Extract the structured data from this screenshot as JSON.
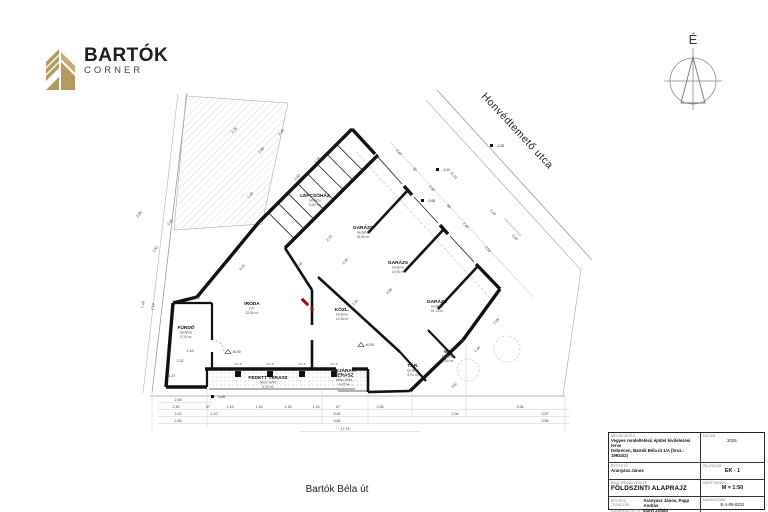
{
  "logo": {
    "name": "BARTÓK",
    "sub": "CORNER",
    "gold": "#b49a5f",
    "dark": "#1d1d1b"
  },
  "north": {
    "label": "É"
  },
  "streets": {
    "top": "Honvédtemető utca",
    "bottom": "Bartók Béla út"
  },
  "boundary_label": "TELEKHATÁR",
  "title_block": {
    "labels": {
      "project": "megnevezés",
      "client": "építtető",
      "date": "dátum",
      "drawing_no": "rajzszám",
      "title": "rajz megnevezése",
      "scale": "méretarány",
      "designers": "építész tervezők",
      "editor": "szerkesztette",
      "job_no": "munkaszám"
    },
    "project_line1": "Vegyes rendeltetésű épület kivitelezési terve",
    "project_line2": "Debrecen, Bartók Béla út 1/A (hrsz.: 19934/2)",
    "client": "Aranyász János",
    "date": "2025.",
    "drawing_no": "EK - 1",
    "title": "FÖLDSZINTI ALAPRAJZ",
    "scale": "M = 1:50",
    "designers": "Aranyász János, Papp András",
    "editor": "Ványi Zoltán",
    "job_no": "E-1-09-0222"
  },
  "plan": {
    "rooms": [
      {
        "n": "LÉPCSŐHÁZ",
        "f": "kerámia",
        "a": "8,50 m²",
        "x": 315,
        "y": 197
      },
      {
        "n": "GARÁZS",
        "f": "kerámia",
        "a": "15,56 m²",
        "x": 363,
        "y": 229
      },
      {
        "n": "GARÁZS",
        "f": "kerámia",
        "a": "14,95 m²",
        "x": 398,
        "y": 264
      },
      {
        "n": "GARÁZS",
        "f": "kerámia",
        "a": "18,14 m²",
        "x": 437,
        "y": 303
      },
      {
        "n": "IRODA",
        "f": "LVT",
        "a": "32,85 m²",
        "x": 252,
        "y": 305
      },
      {
        "n": "KÖZL.",
        "f": "kerámia",
        "a": "14,38 m²",
        "x": 342,
        "y": 311
      },
      {
        "n": "FÜRDŐ",
        "f": "kerámia",
        "a": "5,15 m²",
        "x": 186,
        "y": 329
      },
      {
        "n": "WC",
        "f": "kerámia",
        "a": "2,55 m²",
        "x": 448,
        "y": 353
      },
      {
        "n": "TÁR.",
        "f": "kerámia",
        "a": "8,94 m²",
        "x": 413,
        "y": 367
      },
      {
        "n": "FEDETT TERASZ",
        "f": "beton térkő",
        "a": "6,35 m²",
        "x": 268,
        "y": 379
      },
      {
        "n": "BEJÁRATI",
        "n2": "TERASZ",
        "f": "beton térkő",
        "a": "4,42 m²",
        "x": 344,
        "y": 372
      }
    ],
    "dims": [
      {
        "t": "2,45",
        "x": 178,
        "y": 401
      },
      {
        "t": "2,45",
        "x": 176,
        "y": 408
      },
      {
        "t": "57",
        "x": 208,
        "y": 408
      },
      {
        "t": "1,15",
        "x": 230,
        "y": 408
      },
      {
        "t": "1,15",
        "x": 259,
        "y": 408
      },
      {
        "t": "1,15",
        "x": 288,
        "y": 408
      },
      {
        "t": "1,15",
        "x": 316,
        "y": 408
      },
      {
        "t": "57",
        "x": 338,
        "y": 408
      },
      {
        "t": "3,36",
        "x": 380,
        "y": 408
      },
      {
        "t": "3,36",
        "x": 520,
        "y": 408
      },
      {
        "t": "2,23",
        "x": 178,
        "y": 415
      },
      {
        "t": "1,10",
        "x": 214,
        "y": 415
      },
      {
        "t": "5,84",
        "x": 337,
        "y": 415
      },
      {
        "t": "2,04",
        "x": 455,
        "y": 415
      },
      {
        "t": "3,87",
        "x": 545,
        "y": 415
      },
      {
        "t": "2,46",
        "x": 178,
        "y": 422
      },
      {
        "t": "9,84",
        "x": 337,
        "y": 422
      },
      {
        "t": "3,56",
        "x": 545,
        "y": 422
      },
      {
        "t": "17,74",
        "x": 345,
        "y": 430
      },
      {
        "t": "7,49",
        "x": 144,
        "y": 305,
        "r": -81
      },
      {
        "t": "7,19",
        "x": 154,
        "y": 307,
        "r": -81
      },
      {
        "t": "2,85",
        "x": 140,
        "y": 215,
        "r": -52
      },
      {
        "t": "2,50",
        "x": 171,
        "y": 223,
        "r": -52
      },
      {
        "t": "1,53",
        "x": 156,
        "y": 250,
        "r": -52
      },
      {
        "t": "7,36",
        "x": 196,
        "y": 299
      },
      {
        "t": "2,16",
        "x": 190,
        "y": 352
      },
      {
        "t": "1,32",
        "x": 180,
        "y": 362
      },
      {
        "t": "1,47",
        "x": 172,
        "y": 377
      },
      {
        "t": "2,28",
        "x": 235,
        "y": 131,
        "r": -45
      },
      {
        "t": "2,40",
        "x": 282,
        "y": 133,
        "r": -45
      },
      {
        "t": "2,00",
        "x": 262,
        "y": 151,
        "r": -45
      },
      {
        "t": "2,60",
        "x": 298,
        "y": 178,
        "r": -45
      },
      {
        "t": "2,20",
        "x": 318,
        "y": 161,
        "r": -45
      },
      {
        "t": "1,40",
        "x": 251,
        "y": 196,
        "r": -45
      },
      {
        "t": "2,70",
        "x": 330,
        "y": 239,
        "r": -45
      },
      {
        "t": "2,20",
        "x": 346,
        "y": 262,
        "r": -45
      },
      {
        "t": "2,10",
        "x": 300,
        "y": 266,
        "r": -45
      },
      {
        "t": "4,01",
        "x": 243,
        "y": 268,
        "r": -48
      },
      {
        "t": "2,51",
        "x": 356,
        "y": 303,
        "r": -45
      },
      {
        "t": "3,58",
        "x": 390,
        "y": 292,
        "r": -45
      },
      {
        "t": "2,40",
        "x": 398,
        "y": 153,
        "r": 47
      },
      {
        "t": "90",
        "x": 414,
        "y": 170,
        "r": 47
      },
      {
        "t": "2,40",
        "x": 431,
        "y": 189,
        "r": 47
      },
      {
        "t": "90",
        "x": 448,
        "y": 207,
        "r": 47
      },
      {
        "t": "2,40",
        "x": 465,
        "y": 226,
        "r": 47
      },
      {
        "t": "2,60",
        "x": 487,
        "y": 250,
        "r": 47
      },
      {
        "t": "11,31",
        "x": 453,
        "y": 176,
        "r": 47
      },
      {
        "t": "2,40",
        "x": 492,
        "y": 213,
        "r": 47
      },
      {
        "t": "2,40",
        "x": 514,
        "y": 238,
        "r": 47
      },
      {
        "t": "2,06",
        "x": 497,
        "y": 322,
        "r": -43
      },
      {
        "t": "1,40",
        "x": 478,
        "y": 350,
        "r": -43
      },
      {
        "t": "3,97",
        "x": 455,
        "y": 386,
        "r": -43
      },
      {
        "t": "pm 0",
        "x": 238,
        "y": 365,
        "s": 3.1
      },
      {
        "t": "pm 0",
        "x": 270,
        "y": 365,
        "s": 3.1
      },
      {
        "t": "pm 0",
        "x": 302,
        "y": 365,
        "s": 3.1
      },
      {
        "t": "pm 0",
        "x": 334,
        "y": 365,
        "s": 3.1
      }
    ],
    "levels": [
      {
        "t": "-0,28",
        "x": 497,
        "y": 147
      },
      {
        "t": "-0,10",
        "x": 443,
        "y": 171
      },
      {
        "t": "-0,08",
        "x": 428,
        "y": 202
      },
      {
        "t": "-0,08",
        "x": 218,
        "y": 398
      },
      {
        "t": "±0,00",
        "x": 366,
        "y": 346
      },
      {
        "t": "±0,00",
        "x": 233,
        "y": 353
      }
    ]
  }
}
